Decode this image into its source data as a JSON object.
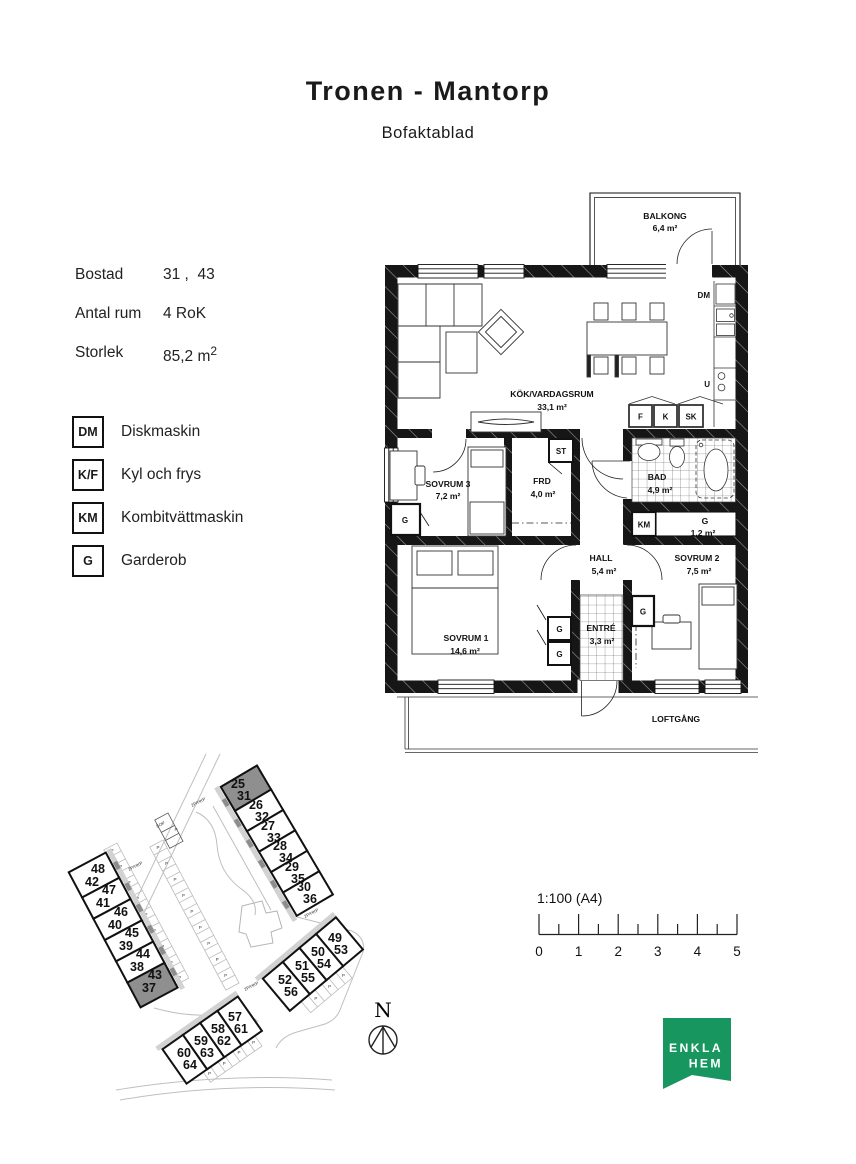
{
  "header": {
    "title": "Tronen - Mantorp",
    "subtitle": "Bofaktablad"
  },
  "info": {
    "rows": [
      {
        "label": "Bostad",
        "value": "31 ,  43"
      },
      {
        "label": "Antal rum",
        "value": "4 RoK"
      },
      {
        "label": "Storlek",
        "value": "85,2 m",
        "sup": "2"
      }
    ]
  },
  "legend": {
    "items": [
      {
        "abbr": "DM",
        "label": "Diskmaskin"
      },
      {
        "abbr": "K/F",
        "label": "Kyl och frys"
      },
      {
        "abbr": "KM",
        "label": "Kombitvättmaskin"
      },
      {
        "abbr": "G",
        "label": "Garderob"
      }
    ]
  },
  "floorplan": {
    "rooms": {
      "balkong": {
        "name": "BALKONG",
        "area": "6,4 m²"
      },
      "kok": {
        "name": "KÖK/VARDAGSRUM",
        "area": "33,1 m²"
      },
      "sovrum3": {
        "name": "SOVRUM 3",
        "area": "7,2 m²"
      },
      "frd": {
        "name": "FRD",
        "area": "4,0 m²"
      },
      "bad": {
        "name": "BAD",
        "area": "4,9 m²"
      },
      "hall": {
        "name": "HALL",
        "area": "5,4 m²"
      },
      "sovrum2": {
        "name": "SOVRUM 2",
        "area": "7,5 m²"
      },
      "sovrum1": {
        "name": "SOVRUM 1",
        "area": "14,6 m²"
      },
      "entre": {
        "name": "ENTRÉ",
        "area": "3,3 m²"
      },
      "garderob": {
        "name": "G",
        "area": "1,2 m²"
      }
    },
    "markers": {
      "st": "ST",
      "km": "KM",
      "g": "G",
      "dm": "DM",
      "u": "U",
      "f": "F",
      "k": "K",
      "sk": "SK"
    },
    "loftgang": "LOFTGÅNG"
  },
  "siteplan": {
    "parking_label": "P",
    "sop_label": "SOP",
    "hkp_label": "2P/HKP",
    "highlight_color": "#8f8f8f",
    "rows": [
      {
        "units": [
          {
            "a": "25",
            "b": "31",
            "highlight": true
          },
          {
            "a": "26",
            "b": "32"
          },
          {
            "a": "27",
            "b": "33"
          },
          {
            "a": "28",
            "b": "34"
          },
          {
            "a": "29",
            "b": "35"
          },
          {
            "a": "30",
            "b": "36"
          }
        ]
      },
      {
        "units": [
          {
            "a": "48",
            "b": "42"
          },
          {
            "a": "47",
            "b": "41"
          },
          {
            "a": "46",
            "b": "40"
          },
          {
            "a": "45",
            "b": "39"
          },
          {
            "a": "44",
            "b": "38"
          },
          {
            "a": "43",
            "b": "37",
            "highlight": true
          }
        ]
      },
      {
        "units": [
          {
            "a": "49",
            "b": "53"
          },
          {
            "a": "50",
            "b": "54"
          },
          {
            "a": "51",
            "b": "55"
          },
          {
            "a": "52",
            "b": "56"
          }
        ]
      },
      {
        "units": [
          {
            "a": "57",
            "b": "61"
          },
          {
            "a": "58",
            "b": "62"
          },
          {
            "a": "59",
            "b": "63"
          },
          {
            "a": "60",
            "b": "64"
          }
        ]
      }
    ]
  },
  "scalebar": {
    "label": "1:100 (A4)",
    "ticks": [
      "0",
      "1",
      "2",
      "3",
      "4",
      "5"
    ]
  },
  "north": {
    "label": "N"
  },
  "logo": {
    "line1": "ENKLA",
    "line2": "HEM",
    "color": "#17975f"
  }
}
